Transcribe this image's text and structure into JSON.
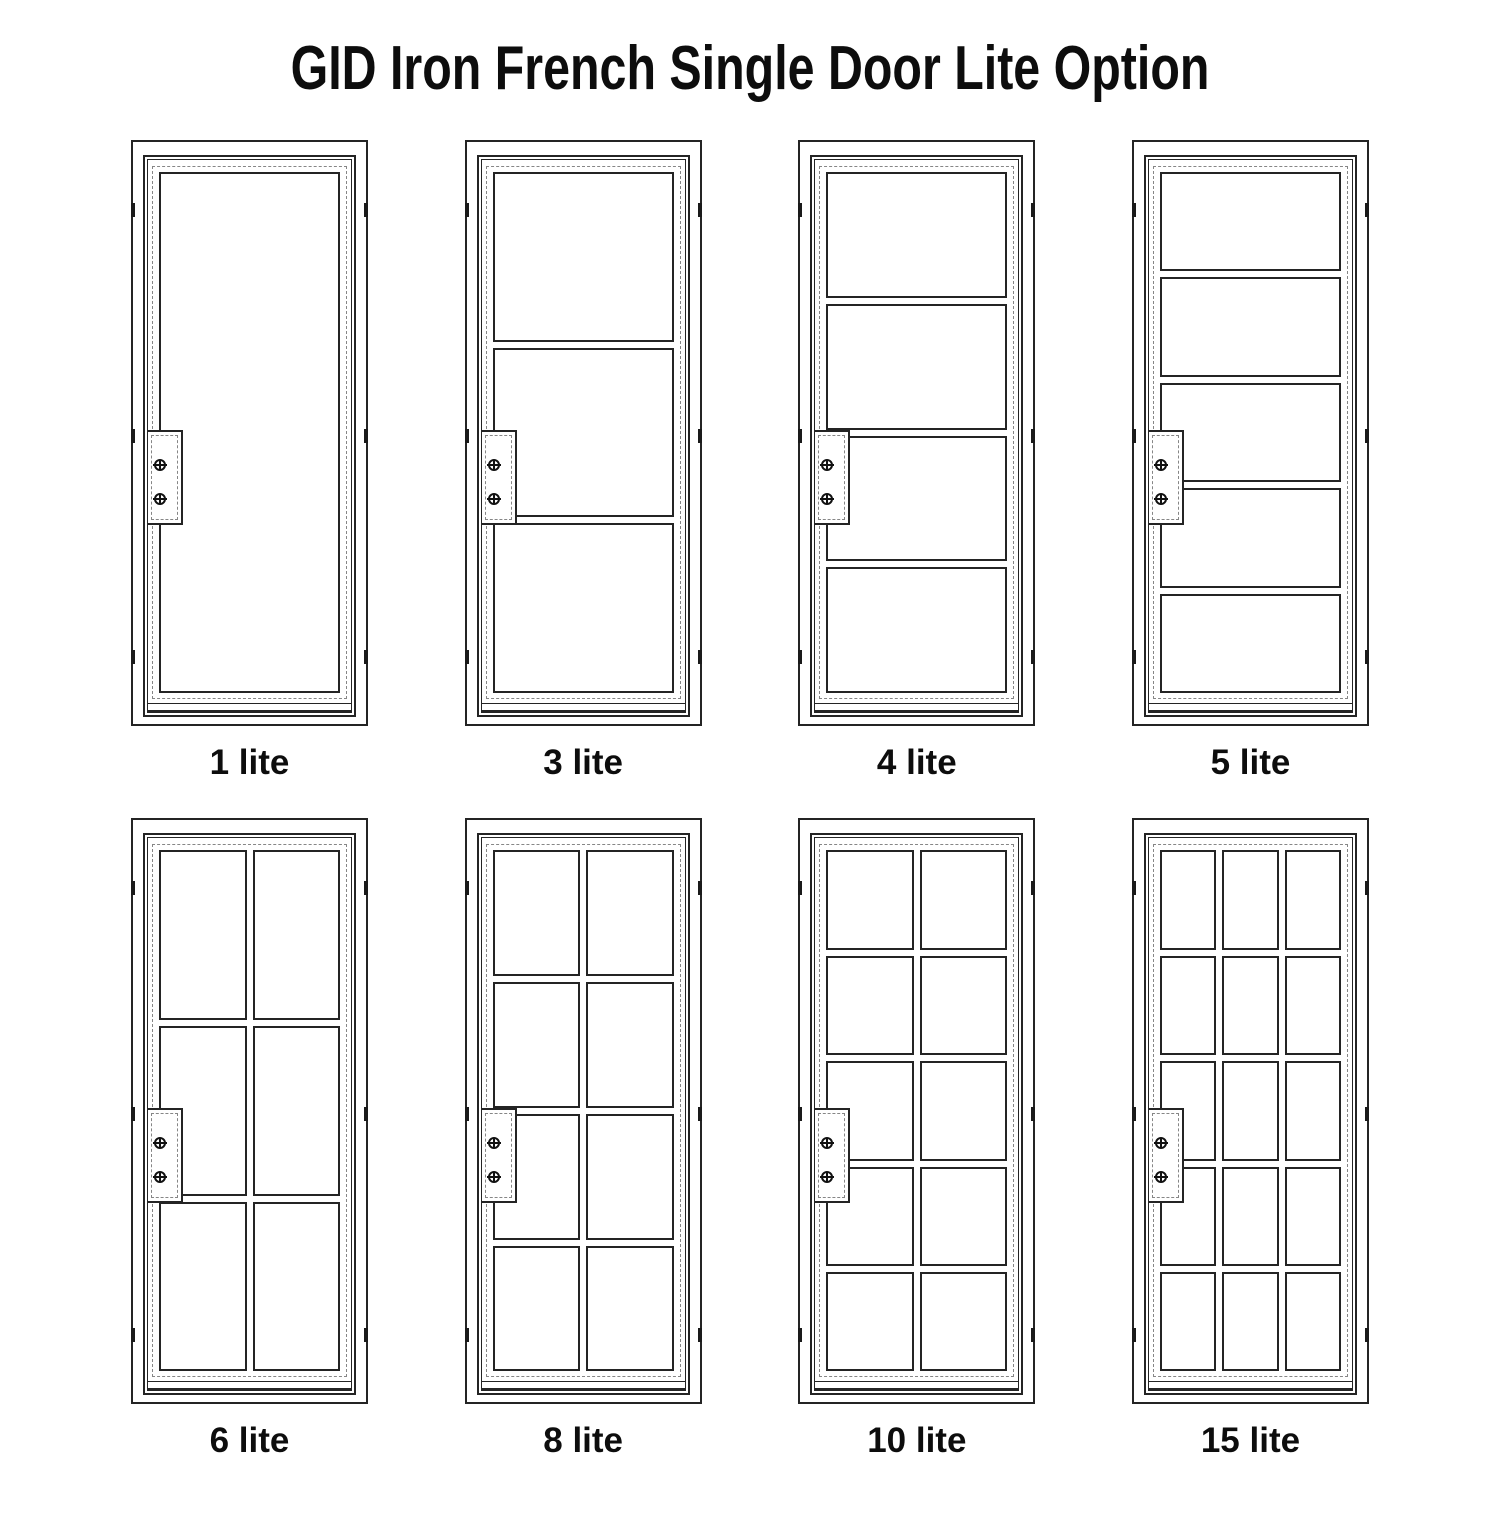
{
  "title": "GID Iron French Single Door Lite Option",
  "colors": {
    "background": "#ffffff",
    "line": "#242424",
    "dashed_line": "#868686",
    "text": "#0d0d0d"
  },
  "icons": {
    "screw": "circle-plus-screw-icon"
  },
  "doors": [
    {
      "label": "1 lite",
      "lites": 1,
      "cols": 1,
      "rows": 1
    },
    {
      "label": "3 lite",
      "lites": 3,
      "cols": 1,
      "rows": 3
    },
    {
      "label": "4 lite",
      "lites": 4,
      "cols": 1,
      "rows": 4
    },
    {
      "label": "5 lite",
      "lites": 5,
      "cols": 1,
      "rows": 5
    },
    {
      "label": "6 lite",
      "lites": 6,
      "cols": 2,
      "rows": 3
    },
    {
      "label": "8 lite",
      "lites": 8,
      "cols": 2,
      "rows": 4
    },
    {
      "label": "10 lite",
      "lites": 10,
      "cols": 2,
      "rows": 5
    },
    {
      "label": "15 lite",
      "lites": 15,
      "cols": 3,
      "rows": 5
    }
  ],
  "layout": {
    "row1_doors": [
      "1 lite",
      "3 lite",
      "4 lite",
      "5 lite"
    ],
    "row2_doors": [
      "6 lite",
      "8 lite",
      "10 lite",
      "15 lite"
    ]
  }
}
